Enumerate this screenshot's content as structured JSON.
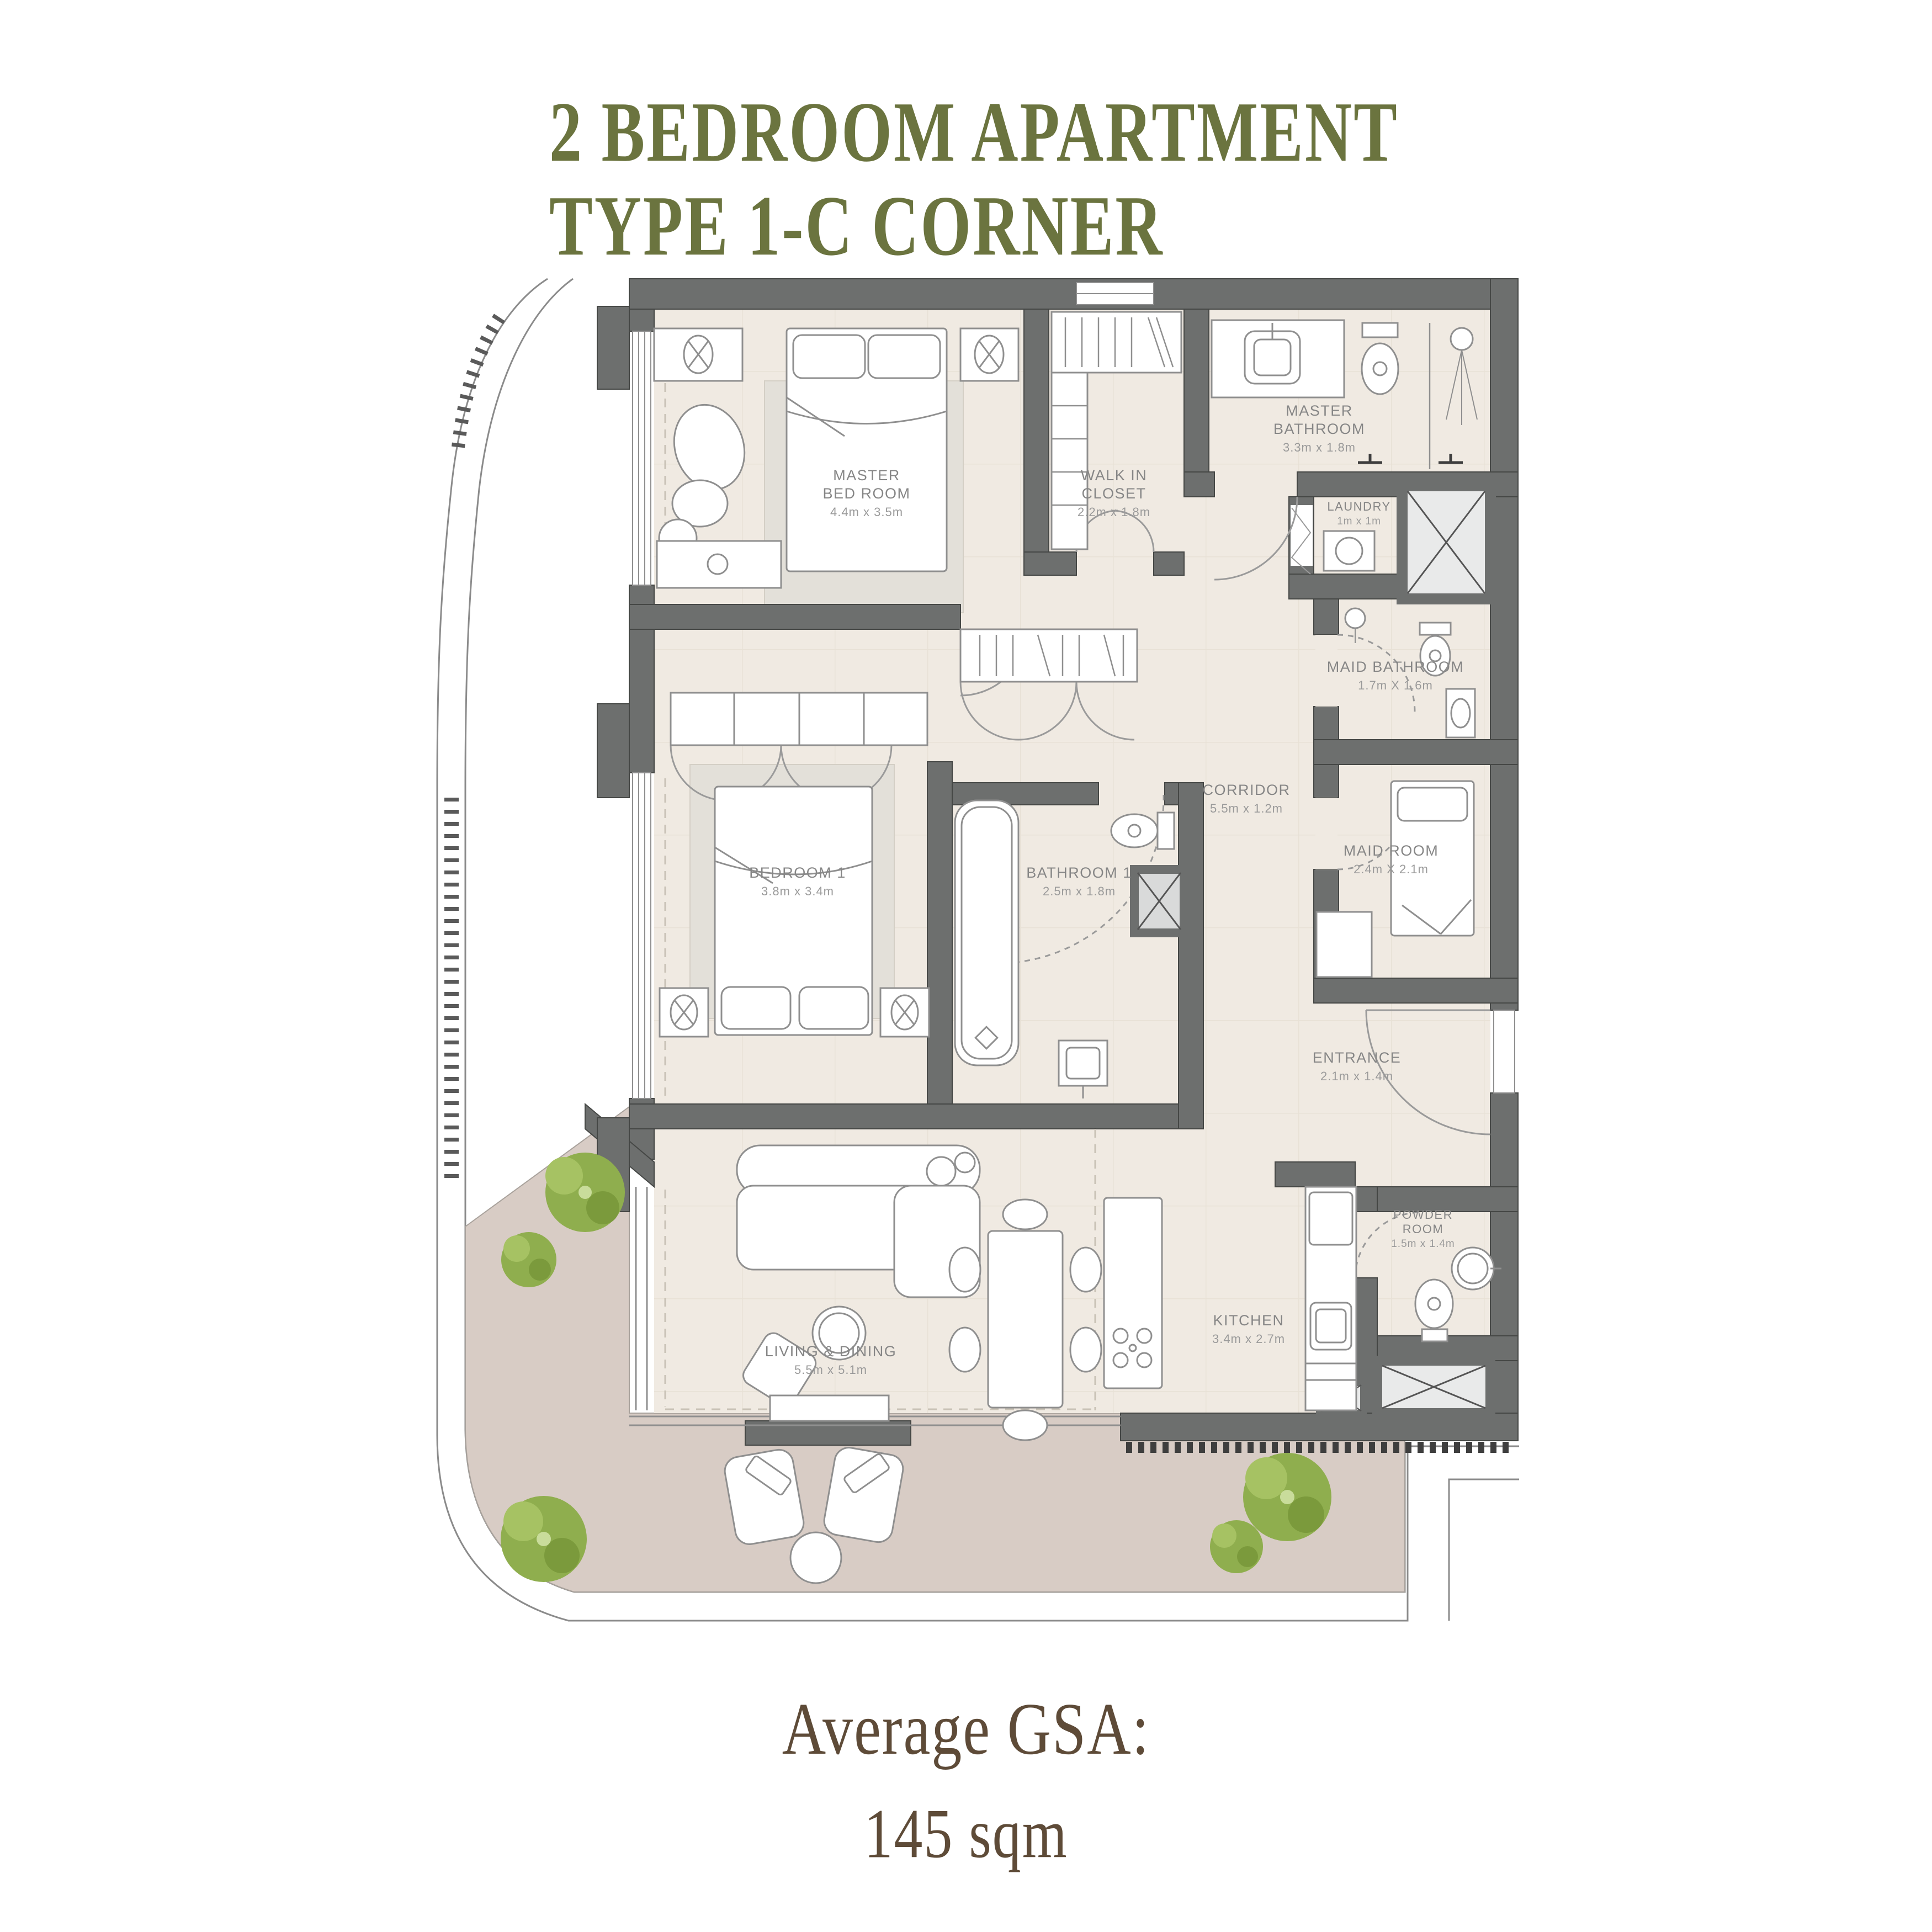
{
  "title": {
    "line1": "2 BEDROOM APARTMENT",
    "line2": "TYPE 1-C CORNER"
  },
  "footer": {
    "line1": "Average GSA:",
    "line2": "145 sqm"
  },
  "rooms": {
    "master_bedroom": {
      "name": "MASTER\nBED ROOM",
      "dims": "4.4m x 3.5m"
    },
    "walk_in_closet": {
      "name": "WALK IN\nCLOSET",
      "dims": "2.2m x 1.8m"
    },
    "master_bathroom": {
      "name": "MASTER\nBATHROOM",
      "dims": "3.3m x 1.8m"
    },
    "laundry": {
      "name": "LAUNDRY",
      "dims": "1m x 1m"
    },
    "maid_bathroom": {
      "name": "MAID BATHROOM",
      "dims": "1.7m X 1.6m"
    },
    "corridor": {
      "name": "CORRIDOR",
      "dims": "5.5m x 1.2m"
    },
    "bedroom_1": {
      "name": "BEDROOM 1",
      "dims": "3.8m x 3.4m"
    },
    "bathroom_1": {
      "name": "BATHROOM 1",
      "dims": "2.5m x 1.8m"
    },
    "maid_room": {
      "name": "MAID ROOM",
      "dims": "2.4m X 2.1m"
    },
    "entrance": {
      "name": "ENTRANCE",
      "dims": "2.1m x 1.4m"
    },
    "living_dining": {
      "name": "LIVING & DINING",
      "dims": "5.5m x 5.1m"
    },
    "kitchen": {
      "name": "KITCHEN",
      "dims": "3.4m x 2.7m"
    },
    "powder_room": {
      "name": "POWDER\nROOM",
      "dims": "1.5m x 1.4m"
    }
  },
  "colors": {
    "title_green": "#6b743f",
    "footer_brown": "#5e4b38",
    "wall_gray": "#6d6f6e",
    "floor_cream": "#f0eae2",
    "balcony_mauve": "#d8ccc5",
    "rug_gray": "#e3e0d9",
    "tree_green": "#8fae4e",
    "label_gray": "#868686"
  }
}
